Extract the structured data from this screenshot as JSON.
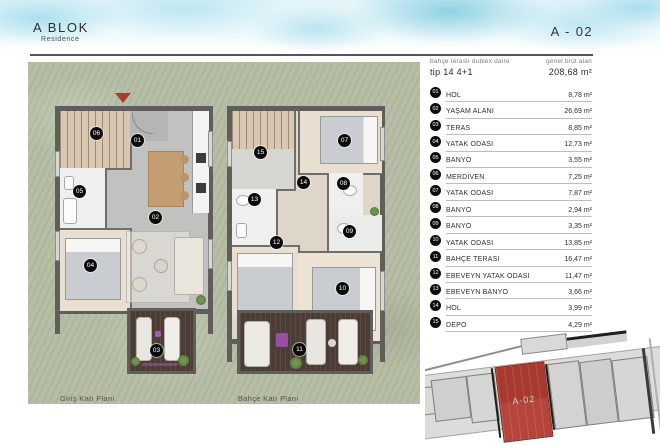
{
  "header": {
    "block_title": "A BLOK",
    "block_subtitle": "Residence",
    "unit_code": "A - 02"
  },
  "summary": {
    "type_label": "bahçe teraslı dublex daire",
    "type_value": "tip 14 4+1",
    "area_label": "genel brüt alan",
    "area_value": "208,68 m²"
  },
  "rooms": [
    {
      "no": "01",
      "name": "HOL",
      "area": "8,78 m²"
    },
    {
      "no": "02",
      "name": "YAŞAM ALANI",
      "area": "26,69 m²"
    },
    {
      "no": "03",
      "name": "TERAS",
      "area": "8,85 m²"
    },
    {
      "no": "04",
      "name": "YATAK ODASI",
      "area": "12,73 m²"
    },
    {
      "no": "05",
      "name": "BANYO",
      "area": "3,55 m²"
    },
    {
      "no": "06",
      "name": "MERDİVEN",
      "area": "7,25 m²"
    },
    {
      "no": "07",
      "name": "YATAK ODASI",
      "area": "7,87 m²"
    },
    {
      "no": "08",
      "name": "BANYO",
      "area": "2,94 m²"
    },
    {
      "no": "09",
      "name": "BANYO",
      "area": "3,35 m²"
    },
    {
      "no": "10",
      "name": "YATAK ODASI",
      "area": "13,85 m²"
    },
    {
      "no": "11",
      "name": "BAHÇE TERASI",
      "area": "16,47 m²"
    },
    {
      "no": "12",
      "name": "EBEVEYN YATAK ODASI",
      "area": "11,47 m²"
    },
    {
      "no": "13",
      "name": "EBEVEYN BANYO",
      "area": "3,66 m²"
    },
    {
      "no": "14",
      "name": "HOL",
      "area": "3,99 m²"
    },
    {
      "no": "15",
      "name": "DEPO",
      "area": "4,29 m²"
    }
  ],
  "plans": {
    "left": {
      "caption": "Giriş Katı Planı",
      "markers": [
        "06",
        "01",
        "05",
        "02",
        "04",
        "03"
      ]
    },
    "right": {
      "caption": "Bahçe Katı Planı",
      "markers": [
        "15",
        "07",
        "14",
        "13",
        "08",
        "09",
        "12",
        "10",
        "11"
      ]
    }
  },
  "site_plan": {
    "unit_label": "A-02"
  },
  "colors": {
    "accent_red": "#a93a2c",
    "unit_highlight": "#a8392f",
    "grass_green": "#b6bea6",
    "terrace_wood": "#4b3d35",
    "wall_gray": "#5f5e5b",
    "watercolor_blue": "#9fdcec"
  }
}
